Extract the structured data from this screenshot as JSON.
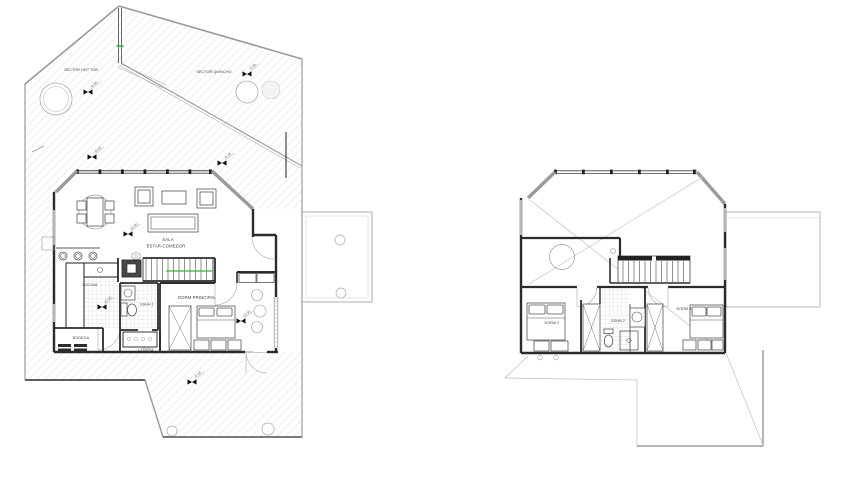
{
  "ground_floor": {
    "labels": {
      "sector_hot_tub": "SECTOR HOT TUB",
      "sector_quincho": "SECTOR QUINCHO",
      "sala": "SALA",
      "estar_comedor": "ESTAR-COMEDOR",
      "cocina": "COCINA",
      "sshh_1": "SSHH 1",
      "dorm_principal": "DORM PRINCIPAL",
      "bodega": "BODEGA",
      "lenera": "LEÑERA"
    },
    "levels": {
      "hot_tub": "-0.34",
      "quincho": "-0.35",
      "deck_nw": "-0.18",
      "deck_ne": "-0.18",
      "sala": "±0.00",
      "cocina": "±0.00",
      "dorm_principal": "±0.00",
      "deck_south": "-0.18"
    }
  },
  "upper_floor": {
    "labels": {
      "dorm_2": "DORM 2",
      "sshh_2": "SSHH 2",
      "dorm_3": "DORM 3"
    }
  },
  "colors": {
    "wall": "#2b2b2b",
    "wall_window_gray": "#9a9a9a",
    "deck_hatch_line": "#d2d2d2",
    "tile_line": "#c4c4c4",
    "furniture_line": "#555555",
    "thin_line": "#aaaaaa",
    "accent_green": "#33bb33",
    "text": "#3d3d3d"
  }
}
